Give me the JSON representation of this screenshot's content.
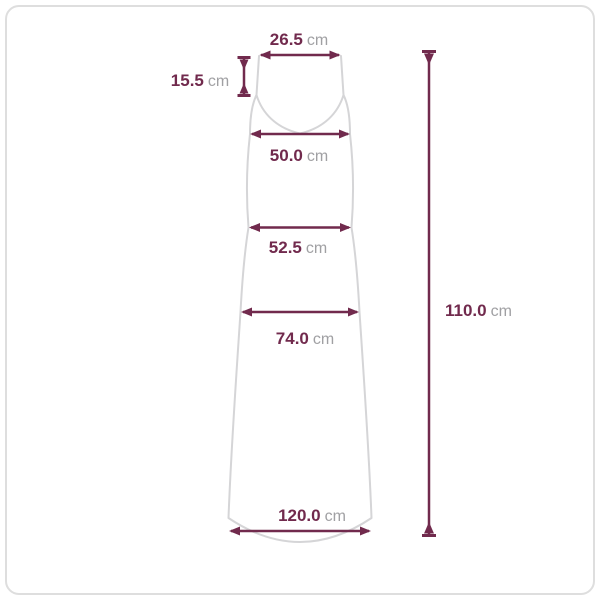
{
  "diagram": {
    "type": "garment-measurement-diagram",
    "subject": "sleeveless v-neck maxi dress, front view",
    "unit": "cm",
    "colors": {
      "measure_line": "#712a4d",
      "value_text": "#712a4d",
      "unit_text": "#a0a0a3",
      "garment_outline": "#d5d5d7",
      "card_border": "#dedede",
      "background": "#ffffff"
    },
    "measurements": {
      "top_width": {
        "value": "26.5",
        "unit": "cm",
        "label": "26.5 cm",
        "location": "between strap tops"
      },
      "strap_drop": {
        "value": "15.5",
        "unit": "cm",
        "label": "15.5 cm",
        "location": "strap length, vertical at left"
      },
      "bust_width": {
        "value": "50.0",
        "unit": "cm",
        "label": "50.0 cm",
        "location": "bust line"
      },
      "waist_width": {
        "value": "52.5",
        "unit": "cm",
        "label": "52.5 cm",
        "location": "waist line"
      },
      "hip_width": {
        "value": "74.0",
        "unit": "cm",
        "label": "74.0 cm",
        "location": "hip line"
      },
      "hem_width": {
        "value": "120.0",
        "unit": "cm",
        "label": "120.0 cm",
        "location": "hem line"
      },
      "total_length": {
        "value": "110.0",
        "unit": "cm",
        "label": "110.0 cm",
        "location": "full length, vertical at right"
      }
    }
  }
}
